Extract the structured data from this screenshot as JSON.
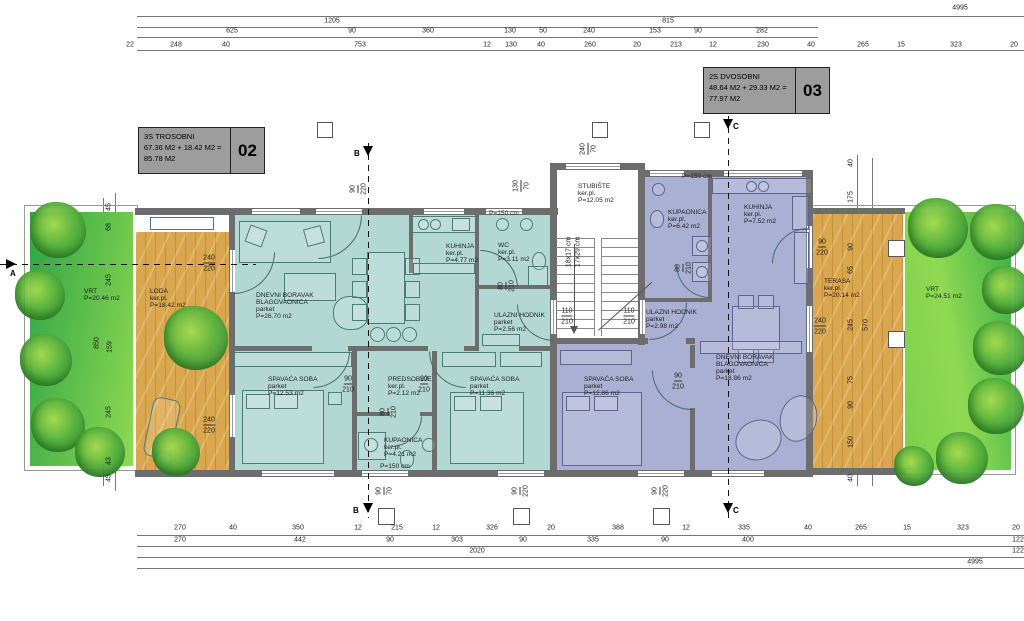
{
  "colors": {
    "teal": "#b3d8d4",
    "purple": "#aab0d3",
    "wall": "#6d6d6d",
    "deck": "#dba74e",
    "deckline": "#c3913c",
    "dim": "#1c1c1c",
    "titlebg": "#9d9d9d",
    "stroke_teal": "#4a7d78",
    "stroke_purple": "#5d6490"
  },
  "sections": {
    "a": "A",
    "b": "B",
    "c": "C"
  },
  "title_blocks": [
    {
      "code": "02",
      "lines": [
        "3S TROSOBNI",
        "67.36 M2 + 18.42 M2 =",
        "85.78 M2"
      ]
    },
    {
      "code": "03",
      "lines": [
        "2S DVOSOBNI",
        "48.64 M2 + 29.33 M2 =",
        "77.97 M2"
      ]
    }
  ],
  "dims": [
    {
      "t": "4995",
      "x": 960,
      "y": 8
    },
    {
      "t": "1205",
      "x": 332,
      "y": 21
    },
    {
      "t": "815",
      "x": 668,
      "y": 21
    },
    {
      "t": "625",
      "x": 232,
      "y": 31
    },
    {
      "t": "90",
      "x": 352,
      "y": 31
    },
    {
      "t": "360",
      "x": 428,
      "y": 31
    },
    {
      "t": "130",
      "x": 510,
      "y": 31
    },
    {
      "t": "50",
      "x": 543,
      "y": 31
    },
    {
      "t": "240",
      "x": 589,
      "y": 31
    },
    {
      "t": "153",
      "x": 655,
      "y": 31
    },
    {
      "t": "90",
      "x": 698,
      "y": 31
    },
    {
      "t": "282",
      "x": 762,
      "y": 31
    },
    {
      "t": "22",
      "x": 130,
      "y": 45
    },
    {
      "t": "248",
      "x": 176,
      "y": 45
    },
    {
      "t": "40",
      "x": 226,
      "y": 45
    },
    {
      "t": "753",
      "x": 360,
      "y": 45
    },
    {
      "t": "12",
      "x": 487,
      "y": 45
    },
    {
      "t": "130",
      "x": 511,
      "y": 45
    },
    {
      "t": "40",
      "x": 541,
      "y": 45
    },
    {
      "t": "260",
      "x": 590,
      "y": 45
    },
    {
      "t": "20",
      "x": 637,
      "y": 45
    },
    {
      "t": "213",
      "x": 676,
      "y": 45
    },
    {
      "t": "12",
      "x": 713,
      "y": 45
    },
    {
      "t": "230",
      "x": 763,
      "y": 45
    },
    {
      "t": "40",
      "x": 811,
      "y": 45
    },
    {
      "t": "265",
      "x": 863,
      "y": 45
    },
    {
      "t": "15",
      "x": 901,
      "y": 45
    },
    {
      "t": "323",
      "x": 956,
      "y": 45
    },
    {
      "t": "20",
      "x": 1014,
      "y": 45
    },
    {
      "t": "270",
      "x": 180,
      "y": 528
    },
    {
      "t": "40",
      "x": 233,
      "y": 528
    },
    {
      "t": "350",
      "x": 298,
      "y": 528
    },
    {
      "t": "12",
      "x": 358,
      "y": 528
    },
    {
      "t": "215",
      "x": 397,
      "y": 528
    },
    {
      "t": "12",
      "x": 436,
      "y": 528
    },
    {
      "t": "326",
      "x": 492,
      "y": 528
    },
    {
      "t": "20",
      "x": 551,
      "y": 528
    },
    {
      "t": "388",
      "x": 618,
      "y": 528
    },
    {
      "t": "12",
      "x": 686,
      "y": 528
    },
    {
      "t": "335",
      "x": 744,
      "y": 528
    },
    {
      "t": "40",
      "x": 808,
      "y": 528
    },
    {
      "t": "265",
      "x": 861,
      "y": 528
    },
    {
      "t": "15",
      "x": 907,
      "y": 528
    },
    {
      "t": "323",
      "x": 963,
      "y": 528
    },
    {
      "t": "20",
      "x": 1016,
      "y": 528
    },
    {
      "t": "270",
      "x": 180,
      "y": 540
    },
    {
      "t": "442",
      "x": 300,
      "y": 540
    },
    {
      "t": "90",
      "x": 390,
      "y": 540
    },
    {
      "t": "303",
      "x": 457,
      "y": 540
    },
    {
      "t": "90",
      "x": 523,
      "y": 540
    },
    {
      "t": "335",
      "x": 593,
      "y": 540
    },
    {
      "t": "90",
      "x": 665,
      "y": 540
    },
    {
      "t": "400",
      "x": 748,
      "y": 540
    },
    {
      "t": "122",
      "x": 1018,
      "y": 540
    },
    {
      "t": "2020",
      "x": 477,
      "y": 551
    },
    {
      "t": "122",
      "x": 1018,
      "y": 551
    },
    {
      "t": "4995",
      "x": 975,
      "y": 562
    },
    {
      "t": "45",
      "x": 109,
      "y": 207,
      "c": "v"
    },
    {
      "t": "68",
      "x": 109,
      "y": 227,
      "c": "v"
    },
    {
      "t": "245",
      "x": 109,
      "y": 280,
      "c": "v"
    },
    {
      "t": "850",
      "x": 97,
      "y": 343,
      "c": "v"
    },
    {
      "t": "159",
      "x": 110,
      "y": 347,
      "c": "v"
    },
    {
      "t": "245",
      "x": 109,
      "y": 412,
      "c": "v"
    },
    {
      "t": "43",
      "x": 109,
      "y": 461,
      "c": "v"
    },
    {
      "t": "45",
      "x": 109,
      "y": 478,
      "c": "v"
    },
    {
      "t": "40",
      "x": 851,
      "y": 163,
      "c": "v"
    },
    {
      "t": "175",
      "x": 851,
      "y": 197,
      "c": "v"
    },
    {
      "t": "90",
      "x": 851,
      "y": 247,
      "c": "v"
    },
    {
      "t": "65",
      "x": 851,
      "y": 270,
      "c": "v"
    },
    {
      "t": "245",
      "x": 851,
      "y": 325,
      "c": "v"
    },
    {
      "t": "570",
      "x": 866,
      "y": 325,
      "c": "v"
    },
    {
      "t": "75",
      "x": 851,
      "y": 380,
      "c": "v"
    },
    {
      "t": "90",
      "x": 851,
      "y": 405,
      "c": "v"
    },
    {
      "t": "150",
      "x": 851,
      "y": 442,
      "c": "v"
    },
    {
      "t": "40",
      "x": 851,
      "y": 478,
      "c": "v"
    },
    {
      "t": "90",
      "x": 354,
      "y": 189,
      "c": "v u"
    },
    {
      "t": "220",
      "x": 364,
      "y": 189,
      "c": "v"
    },
    {
      "t": "130",
      "x": 517,
      "y": 186,
      "c": "v u"
    },
    {
      "t": "70",
      "x": 527,
      "y": 186,
      "c": "v"
    },
    {
      "t": "240",
      "x": 584,
      "y": 149,
      "c": "v u"
    },
    {
      "t": "70",
      "x": 594,
      "y": 149,
      "c": "v"
    },
    {
      "t": "80",
      "x": 502,
      "y": 286,
      "c": "v u"
    },
    {
      "t": "210",
      "x": 512,
      "y": 286,
      "c": "v"
    },
    {
      "t": "80",
      "x": 679,
      "y": 268,
      "c": "v u"
    },
    {
      "t": "210",
      "x": 689,
      "y": 268,
      "c": "v"
    },
    {
      "t": "80",
      "x": 384,
      "y": 412,
      "c": "v u"
    },
    {
      "t": "210",
      "x": 394,
      "y": 412,
      "c": "v"
    },
    {
      "t": "90",
      "x": 380,
      "y": 491,
      "c": "v u"
    },
    {
      "t": "70",
      "x": 390,
      "y": 491,
      "c": "v"
    },
    {
      "t": "90",
      "x": 516,
      "y": 491,
      "c": "v u"
    },
    {
      "t": "220",
      "x": 526,
      "y": 491,
      "c": "v"
    },
    {
      "t": "90",
      "x": 656,
      "y": 491,
      "c": "v u"
    },
    {
      "t": "220",
      "x": 666,
      "y": 491,
      "c": "v"
    },
    {
      "t": "18x17 cm",
      "x": 569,
      "y": 252,
      "c": "v"
    },
    {
      "t": "17x29 cm",
      "x": 578,
      "y": 252,
      "c": "v"
    },
    {
      "t": "110",
      "x": 567,
      "y": 312,
      "c": "u"
    },
    {
      "t": "210",
      "x": 567,
      "y": 322
    },
    {
      "t": "110",
      "x": 629,
      "y": 312,
      "c": "u"
    },
    {
      "t": "210",
      "x": 629,
      "y": 322
    },
    {
      "t": "90",
      "x": 348,
      "y": 380,
      "c": "u"
    },
    {
      "t": "210",
      "x": 348,
      "y": 390
    },
    {
      "t": "90",
      "x": 424,
      "y": 380,
      "c": "u"
    },
    {
      "t": "210",
      "x": 424,
      "y": 390
    },
    {
      "t": "90",
      "x": 678,
      "y": 377,
      "c": "u"
    },
    {
      "t": "210",
      "x": 678,
      "y": 387
    },
    {
      "t": "90",
      "x": 822,
      "y": 243,
      "c": "u"
    },
    {
      "t": "220",
      "x": 822,
      "y": 253
    },
    {
      "t": "240",
      "x": 820,
      "y": 322,
      "c": "u"
    },
    {
      "t": "220",
      "x": 820,
      "y": 332
    },
    {
      "t": "240",
      "x": 209,
      "y": 259,
      "c": "u"
    },
    {
      "t": "220",
      "x": 209,
      "y": 269
    },
    {
      "t": "240",
      "x": 209,
      "y": 421,
      "c": "u"
    },
    {
      "t": "220",
      "x": 209,
      "y": 431
    }
  ],
  "rooms": [
    {
      "t": "DNEVNI BORAVAK",
      "x": 256,
      "y": 293
    },
    {
      "t": "BLAGOVAONICA",
      "x": 256,
      "y": 300
    },
    {
      "t": "parket",
      "x": 256,
      "y": 307
    },
    {
      "t": "P=26.70 m2",
      "x": 256,
      "y": 314
    },
    {
      "t": "KUHINJA",
      "x": 446,
      "y": 244
    },
    {
      "t": "ker.pl.",
      "x": 446,
      "y": 251
    },
    {
      "t": "P=4.77 m2",
      "x": 446,
      "y": 258
    },
    {
      "t": "WC",
      "x": 498,
      "y": 243
    },
    {
      "t": "ker.pl.",
      "x": 498,
      "y": 250
    },
    {
      "t": "P=3.11 m2",
      "x": 498,
      "y": 257
    },
    {
      "t": "P=150 cm",
      "x": 489,
      "y": 211
    },
    {
      "t": "ULAZNI HODNIK",
      "x": 494,
      "y": 313
    },
    {
      "t": "parket",
      "x": 494,
      "y": 320
    },
    {
      "t": "P=2.56 m2",
      "x": 494,
      "y": 327
    },
    {
      "t": "SPAVAĆA SOBA",
      "x": 268,
      "y": 377
    },
    {
      "t": "parket",
      "x": 268,
      "y": 384
    },
    {
      "t": "P=12.53 m2",
      "x": 268,
      "y": 391
    },
    {
      "t": "PREDSOBLJE",
      "x": 388,
      "y": 377
    },
    {
      "t": "ker.pl.",
      "x": 388,
      "y": 384
    },
    {
      "t": "P=2.12 m2",
      "x": 388,
      "y": 391
    },
    {
      "t": "KUPAONICA",
      "x": 384,
      "y": 438
    },
    {
      "t": "ker.pl.",
      "x": 384,
      "y": 445
    },
    {
      "t": "P=4.21 m2",
      "x": 384,
      "y": 452
    },
    {
      "t": "P=150 cm",
      "x": 380,
      "y": 464
    },
    {
      "t": "SPAVAĆA SOBA",
      "x": 470,
      "y": 377
    },
    {
      "t": "parket",
      "x": 470,
      "y": 384
    },
    {
      "t": "P=11.36 m2",
      "x": 470,
      "y": 391
    },
    {
      "t": "STUBIŠTE",
      "x": 578,
      "y": 184
    },
    {
      "t": "ker.pl.",
      "x": 578,
      "y": 191
    },
    {
      "t": "P=12.05 m2",
      "x": 578,
      "y": 198
    },
    {
      "t": "KUPAONICA",
      "x": 668,
      "y": 210
    },
    {
      "t": "ker.pl.",
      "x": 668,
      "y": 217
    },
    {
      "t": "P=6.42 m2",
      "x": 668,
      "y": 224
    },
    {
      "t": "P=150 cm",
      "x": 682,
      "y": 174
    },
    {
      "t": "KUHINJA",
      "x": 744,
      "y": 205
    },
    {
      "t": "ker.pl.",
      "x": 744,
      "y": 212
    },
    {
      "t": "P=7.52 m2",
      "x": 744,
      "y": 219
    },
    {
      "t": "ULAZNI HODNIK",
      "x": 646,
      "y": 310
    },
    {
      "t": "parket",
      "x": 646,
      "y": 317
    },
    {
      "t": "P=2.98 m2",
      "x": 646,
      "y": 324
    },
    {
      "t": "DNEVNI BORAVAK",
      "x": 716,
      "y": 355
    },
    {
      "t": "BLAGOVAONICA",
      "x": 716,
      "y": 362
    },
    {
      "t": "parket",
      "x": 716,
      "y": 369
    },
    {
      "t": "P=18.86 m2",
      "x": 716,
      "y": 376
    },
    {
      "t": "SPAVAĆA SOBA",
      "x": 584,
      "y": 377
    },
    {
      "t": "parket",
      "x": 584,
      "y": 384
    },
    {
      "t": "P=12.86 m2",
      "x": 584,
      "y": 391
    },
    {
      "t": "LODA",
      "x": 150,
      "y": 289
    },
    {
      "t": "ker.pl.",
      "x": 150,
      "y": 296
    },
    {
      "t": "P=18.42 m2",
      "x": 150,
      "y": 303
    },
    {
      "t": "VRT",
      "x": 84,
      "y": 289
    },
    {
      "t": "P=20.46 m2",
      "x": 84,
      "y": 296
    },
    {
      "t": "TERASA",
      "x": 824,
      "y": 279
    },
    {
      "t": "ker.pl.",
      "x": 824,
      "y": 286
    },
    {
      "t": "P=20.14 m2",
      "x": 824,
      "y": 293
    },
    {
      "t": "VRT",
      "x": 926,
      "y": 287
    },
    {
      "t": "P=24.51 m2",
      "x": 926,
      "y": 294
    }
  ]
}
